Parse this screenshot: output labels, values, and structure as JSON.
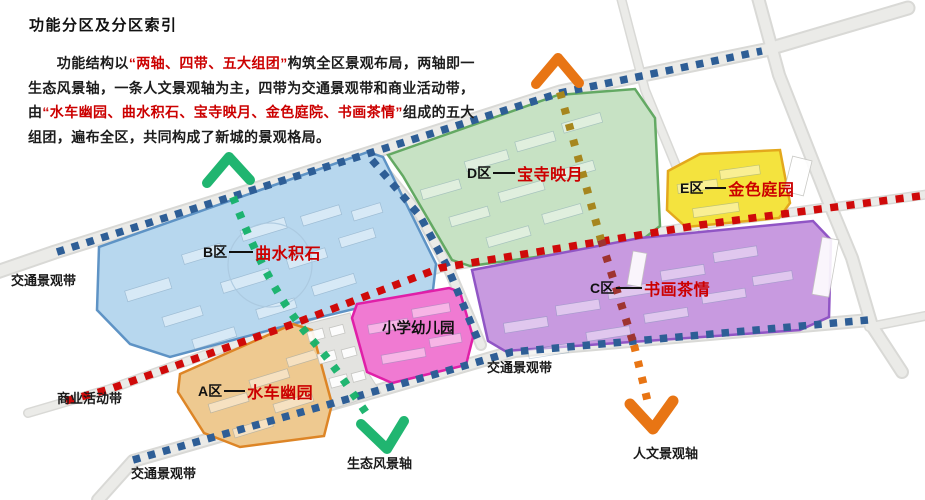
{
  "header": {
    "title": "功能分区及分区索引",
    "paragraph": {
      "seg1": "　　功能结构以",
      "highlight1": "“两轴、四带、五大组团”",
      "seg2": "构筑全区景观布局，两轴即一生态风景轴，一条人文景观轴为主，四带为交通景观带和商业活动带，由",
      "highlight2": "“水车幽园、曲水积石、宝寺映月、金色庭院、书画茶情”",
      "seg3": "组成的五大组团，遍布全区，共同构成了新城的景观格局。"
    }
  },
  "zones": {
    "a": {
      "code": "A区",
      "name": "水车幽园",
      "fill": "#eec990",
      "stroke": "#dd8526"
    },
    "b": {
      "code": "B区",
      "name": "曲水积石",
      "fill": "#b7d7ee",
      "stroke": "#5e93c5"
    },
    "c": {
      "code": "C区",
      "name": "书画茶情",
      "fill": "#c89ae0",
      "stroke": "#9055c5"
    },
    "d": {
      "code": "D区",
      "name": "宝寺映月",
      "fill": "#c7e2c4",
      "stroke": "#63a963"
    },
    "e": {
      "code": "E区",
      "name": "金色庭园",
      "fill": "#f4e33e",
      "stroke": "#e3a81c"
    },
    "school": {
      "name": "小学幼儿园",
      "fill": "#f07ad2",
      "stroke": "#e01fa8"
    }
  },
  "map_labels": {
    "traffic_top": "交通景观带",
    "traffic_mid": "交通景观带",
    "traffic_bottom": "交通景观带",
    "commerce": "商业活动带",
    "eco_axis": "生态风景轴",
    "culture_axis": "人文景观轴"
  },
  "colors": {
    "traffic_belt": "#2e5e96",
    "commerce_belt": "#cf0a0a",
    "eco_axis": "#15b269",
    "culture_axis": "#e87514",
    "culture_axis_on_green": "#a6861e",
    "culture_axis_on_purple": "#9e3430",
    "highlight_red": "#cc0000",
    "road": "#ebebe8"
  }
}
